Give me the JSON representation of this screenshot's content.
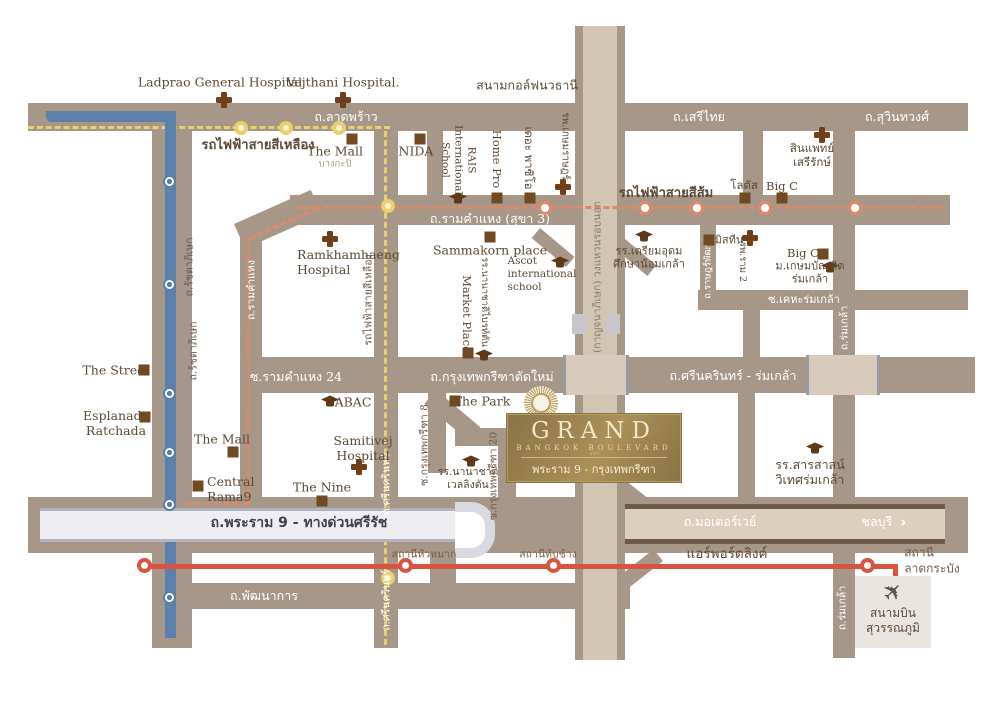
{
  "logo": {
    "name": "GRAND",
    "subtitle": "BANGKOK BOULEVARD",
    "location": "พระราม 9 - กรุงเทพกรีฑา",
    "accent_color": "#a08a52"
  },
  "icons": {
    "plane": "✈",
    "arrow_right": "›",
    "zigzag": "∨∨∨"
  },
  "roads": {
    "ladprao": "ถ.ลาดพร้าว",
    "serithai": "ถ.เสรีไทย",
    "suwinthawong": "ถ.สุวินทวงศ์",
    "ramkhamhaeng_h": "ถ.รามคำแหง (สุขา 3)",
    "ramkhamhaeng_v": "ถ.รามคำแหง",
    "ratchadaphisek": "ถ.รัชดาภิเษก",
    "srinagarindra": "ถ.ศรีนครินทร์",
    "rk24": "ซ.รามคำแหง 24",
    "kreetha_new": "ถ.กรุงเทพกรีฑาตัดใหม่",
    "srinakarin_romklao": "ถ.ศรีนครินทร์ - ร่มเกล้า",
    "kheha_romklao": "ซ.เคหะร่มเกล้า",
    "rat_phatthana": "ถ.ราษฎร์พัฒนา",
    "romklao": "ถ.ร่มเกล้า",
    "motorway": "ถ.มอเตอร์เวย์",
    "chonburi": "ชลบุรี",
    "pattanakarn": "ถ.พัฒนาการ",
    "rama9": "ถ.พระราม 9 - ทางด่วนศรีรัช",
    "kanchanaphisek": "(กาญจนาภิเษก) วงแหวนรอบนอก",
    "kreetha8": "ซ.กรุงเทพกรีฑา 8",
    "kreetha20": "ซ.กรุงเทพกรีฑา 20"
  },
  "transit": {
    "yellow_line": "รถไฟฟ้าสายสีเหลือง",
    "orange_line": "รถไฟฟ้าสายสีส้ม",
    "airport_link": "แอร์พอร์ตลิงค์",
    "station_huamak": "สถานีหัวหมาก",
    "station_thapchang": "สถานีทับช้าง",
    "station_ladkrabang": {
      "lines": [
        "สถานี",
        "ลาดกระบัง"
      ]
    },
    "colors": {
      "yellow": "#e9cf6d",
      "orange": "#e0896a",
      "blue": "#5b80ab",
      "red": "#d85340"
    }
  },
  "landmarks": {
    "ladprao_hospital": "Ladprao General Hospital",
    "vejthani_hospital": "Vejthani Hospital.",
    "navatanee_golf": "สนามกอล์ฟนวธานี",
    "themall_bangkapi": {
      "name": "The Mall",
      "sub": "บางกะปิ"
    },
    "nida": "NIDA",
    "rais": {
      "lines": [
        "RAIS",
        "International",
        "School"
      ]
    },
    "homepro": "Home Pro",
    "paseo": "เดอะ พาซิโอ",
    "kasemrad": "รพ.เกษมราษฎร์",
    "sinphaet": {
      "lines": [
        "สินแพทย์",
        "เสรีรักษ์"
      ]
    },
    "lotus": "โลตัส",
    "bigc_top": "Big C",
    "ramkhamhaeng_hospital": {
      "lines": [
        "Ramkhamhaeng",
        "Hospital"
      ]
    },
    "sammakorn": "Sammakorn place",
    "ascot": {
      "lines": [
        "Ascot",
        "international",
        "school"
      ]
    },
    "marketplace": "Market Place",
    "brighton": "รร.นานาชาติไบรท์ตัน",
    "mistine": "มิสทีน",
    "ram2": "รพ.ราม 2",
    "bigc_right": "Big C",
    "kasembundit": {
      "lines": [
        "ม.เกษมบัณฑิต",
        "ร่มเกล้า"
      ]
    },
    "triamudom": {
      "lines": [
        "รร.เตรียมอุดม",
        "ศึกษาน้อมเกล้า"
      ]
    },
    "thestreet": "The Street",
    "esplanade": {
      "lines": [
        "Esplanade",
        "Ratchada"
      ]
    },
    "abac": "ABAC",
    "thepark": "The Park",
    "themall_rama9": "The Mall",
    "central_rama9": {
      "lines": [
        "Central",
        "Rama9"
      ]
    },
    "samitivej": {
      "lines": [
        "Samitivej",
        "Hospital"
      ]
    },
    "thenine": "The Nine",
    "wellington": {
      "lines": [
        "รร.นานาชาติ",
        "เวลลิงตัน"
      ]
    },
    "sarasas": {
      "lines": [
        "รร.สารสาสน์",
        "วิเทศร่มเกล้า"
      ]
    },
    "airport": {
      "lines": [
        "สนามบิน",
        "สุวรรณภูมิ"
      ]
    }
  }
}
